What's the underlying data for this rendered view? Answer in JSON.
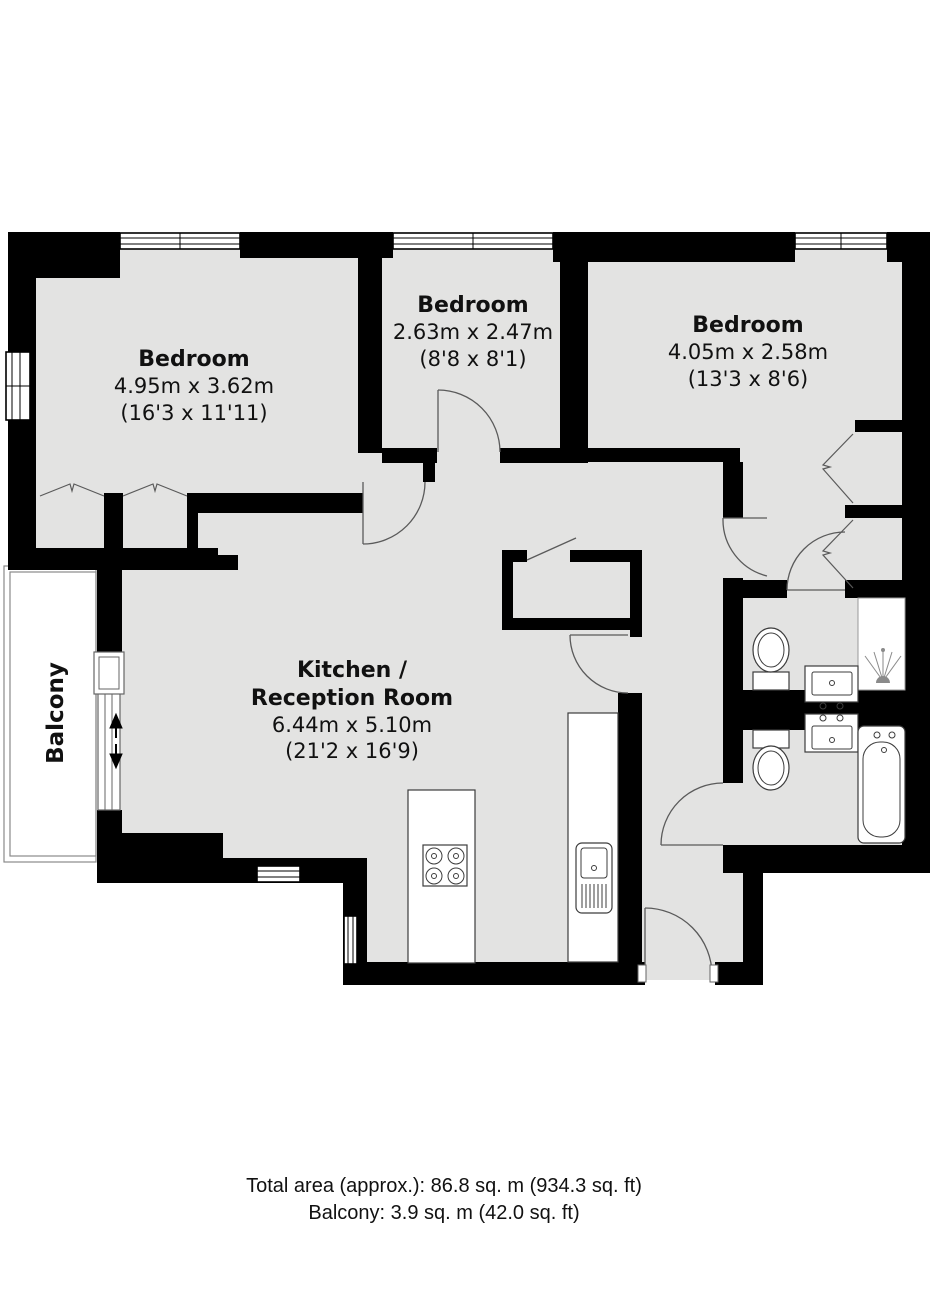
{
  "plan": {
    "rooms": [
      {
        "name": "Bedroom",
        "dims_m": "4.95m x 3.62m",
        "dims_ft": "(16'3 x 11'11)"
      },
      {
        "name": "Bedroom",
        "dims_m": "2.63m x 2.47m",
        "dims_ft": "(8'8 x 8'1)"
      },
      {
        "name": "Bedroom",
        "dims_m": "4.05m x 2.58m",
        "dims_ft": "(13'3 x 8'6)"
      },
      {
        "name_line1": "Kitchen /",
        "name_line2": "Reception Room",
        "dims_m": "6.44m x 5.10m",
        "dims_ft": "(21'2 x 16'9)"
      }
    ],
    "balcony_label": "Balcony",
    "colors": {
      "wall": "#000000",
      "floor": "#e3e3e2",
      "background": "#ffffff"
    }
  },
  "footer": {
    "line1": "Total area (approx.): 86.8 sq. m (934.3 sq. ft)",
    "line2": "Balcony: 3.9 sq. m (42.0 sq. ft)"
  }
}
